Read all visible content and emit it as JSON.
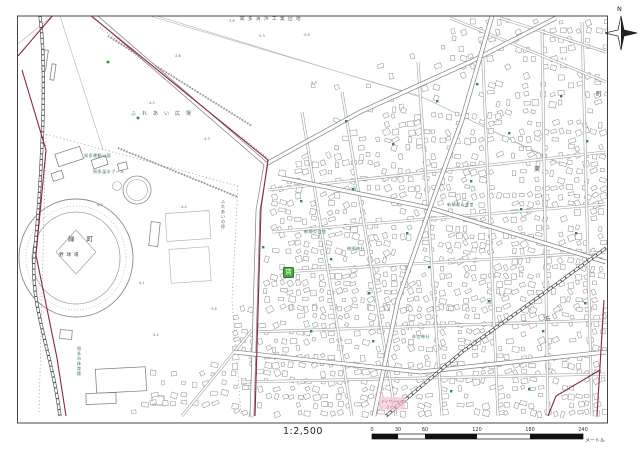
{
  "map": {
    "scale_text": "1:2,500",
    "scale_bar": {
      "ticks": [
        "0",
        "30",
        "60",
        "120",
        "180",
        "240"
      ],
      "unit": "メートル"
    },
    "compass_label": "N",
    "marker": {
      "label": "賃",
      "color": "#4aa545"
    },
    "labels": [
      {
        "text": "知多清浜工業団地",
        "x": 240,
        "y": 20,
        "size": 4.5,
        "ls": 3.5,
        "color": "#555555"
      },
      {
        "text": "ふれあい広場",
        "x": 131,
        "y": 115,
        "size": 5,
        "ls": 6,
        "color": "#4a6a6a"
      },
      {
        "text": "知多運動公園",
        "x": 84,
        "y": 157,
        "size": 4,
        "ls": 0.5,
        "color": "#2a6f6f"
      },
      {
        "text": "知多温水プール",
        "x": 93,
        "y": 173,
        "size": 4,
        "ls": 0.5,
        "color": "#2a6f6f"
      },
      {
        "text": "緑町",
        "x": 68,
        "y": 241,
        "size": 6.5,
        "ls": 12,
        "color": "#444444"
      },
      {
        "text": "野球場",
        "x": 59,
        "y": 256,
        "size": 4.5,
        "ls": 3,
        "color": "#444444"
      },
      {
        "text": "知多市体育館",
        "x": 77,
        "y": 350,
        "size": 4,
        "ls": 0.5,
        "color": "#2a6f6f",
        "vertical": true
      },
      {
        "text": "ふれあいの径",
        "x": 221,
        "y": 203,
        "size": 4,
        "ls": 0.5,
        "color": "#555555",
        "vertical": true
      },
      {
        "text": "新知公会堂",
        "x": 304,
        "y": 233,
        "size": 4,
        "ls": 0.5,
        "color": "#2a6f6f"
      },
      {
        "text": "神明神社",
        "x": 347,
        "y": 250,
        "size": 4,
        "ls": 0.5,
        "color": "#2a6f6f"
      },
      {
        "text": "新知東公会堂",
        "x": 447,
        "y": 206,
        "size": 4,
        "ls": 0.5,
        "color": "#2a6f6f"
      },
      {
        "text": "牟山神社",
        "x": 412,
        "y": 338,
        "size": 4,
        "ls": 0.5,
        "color": "#2a6f6f"
      },
      {
        "text": "東",
        "x": 534,
        "y": 171,
        "size": 6,
        "ls": 0,
        "color": "#555555"
      },
      {
        "text": "町",
        "x": 596,
        "y": 96,
        "size": 6,
        "ls": 0,
        "color": "#555555"
      },
      {
        "text": "丘",
        "x": 545,
        "y": 321,
        "size": 6,
        "ls": 0,
        "color": "#555555"
      },
      {
        "text": "デイサービス",
        "x": 381,
        "y": 403,
        "size": 3.8,
        "ls": 0,
        "color": "#c2527a"
      },
      {
        "text": "さくら",
        "x": 386,
        "y": 408.5,
        "size": 3.8,
        "ls": 0,
        "color": "#c2527a"
      }
    ],
    "elevations": [
      {
        "text": "·4.5",
        "x": 148,
        "y": 104
      },
      {
        "text": "·4.3",
        "x": 203,
        "y": 140
      },
      {
        "text": "·5.3",
        "x": 258,
        "y": 37
      },
      {
        "text": "·5.9",
        "x": 303,
        "y": 36
      },
      {
        "text": "·5.3",
        "x": 310,
        "y": 84
      },
      {
        "text": "·2.8",
        "x": 174,
        "y": 57
      },
      {
        "text": "·4.4",
        "x": 180,
        "y": 208
      },
      {
        "text": "·4.1",
        "x": 138,
        "y": 284
      },
      {
        "text": "·5.6",
        "x": 498,
        "y": 296
      },
      {
        "text": "·2.1",
        "x": 406,
        "y": 330
      },
      {
        "text": "·4.4",
        "x": 152,
        "y": 336
      },
      {
        "text": "·3.6",
        "x": 228,
        "y": 22
      },
      {
        "text": "·4.2",
        "x": 96,
        "y": 206
      },
      {
        "text": "·5.1",
        "x": 560,
        "y": 60
      },
      {
        "text": "·3.4",
        "x": 210,
        "y": 310
      }
    ],
    "hydrants": [
      [
        345,
        120
      ],
      [
        392,
        143
      ],
      [
        436,
        100
      ],
      [
        476,
        83
      ],
      [
        508,
        132
      ],
      [
        560,
        95
      ],
      [
        586,
        140
      ],
      [
        470,
        180
      ],
      [
        520,
        208
      ],
      [
        575,
        232
      ],
      [
        330,
        258
      ],
      [
        368,
        292
      ],
      [
        428,
        266
      ],
      [
        488,
        300
      ],
      [
        542,
        330
      ],
      [
        372,
        340
      ],
      [
        310,
        330
      ],
      [
        450,
        390
      ],
      [
        528,
        388
      ],
      [
        584,
        302
      ],
      [
        300,
        200
      ],
      [
        262,
        246
      ],
      [
        406,
        232
      ],
      [
        352,
        188
      ]
    ],
    "trees": [
      [
        138,
        118
      ],
      [
        405,
        11
      ],
      [
        415,
        13
      ],
      [
        108,
        62
      ]
    ]
  }
}
